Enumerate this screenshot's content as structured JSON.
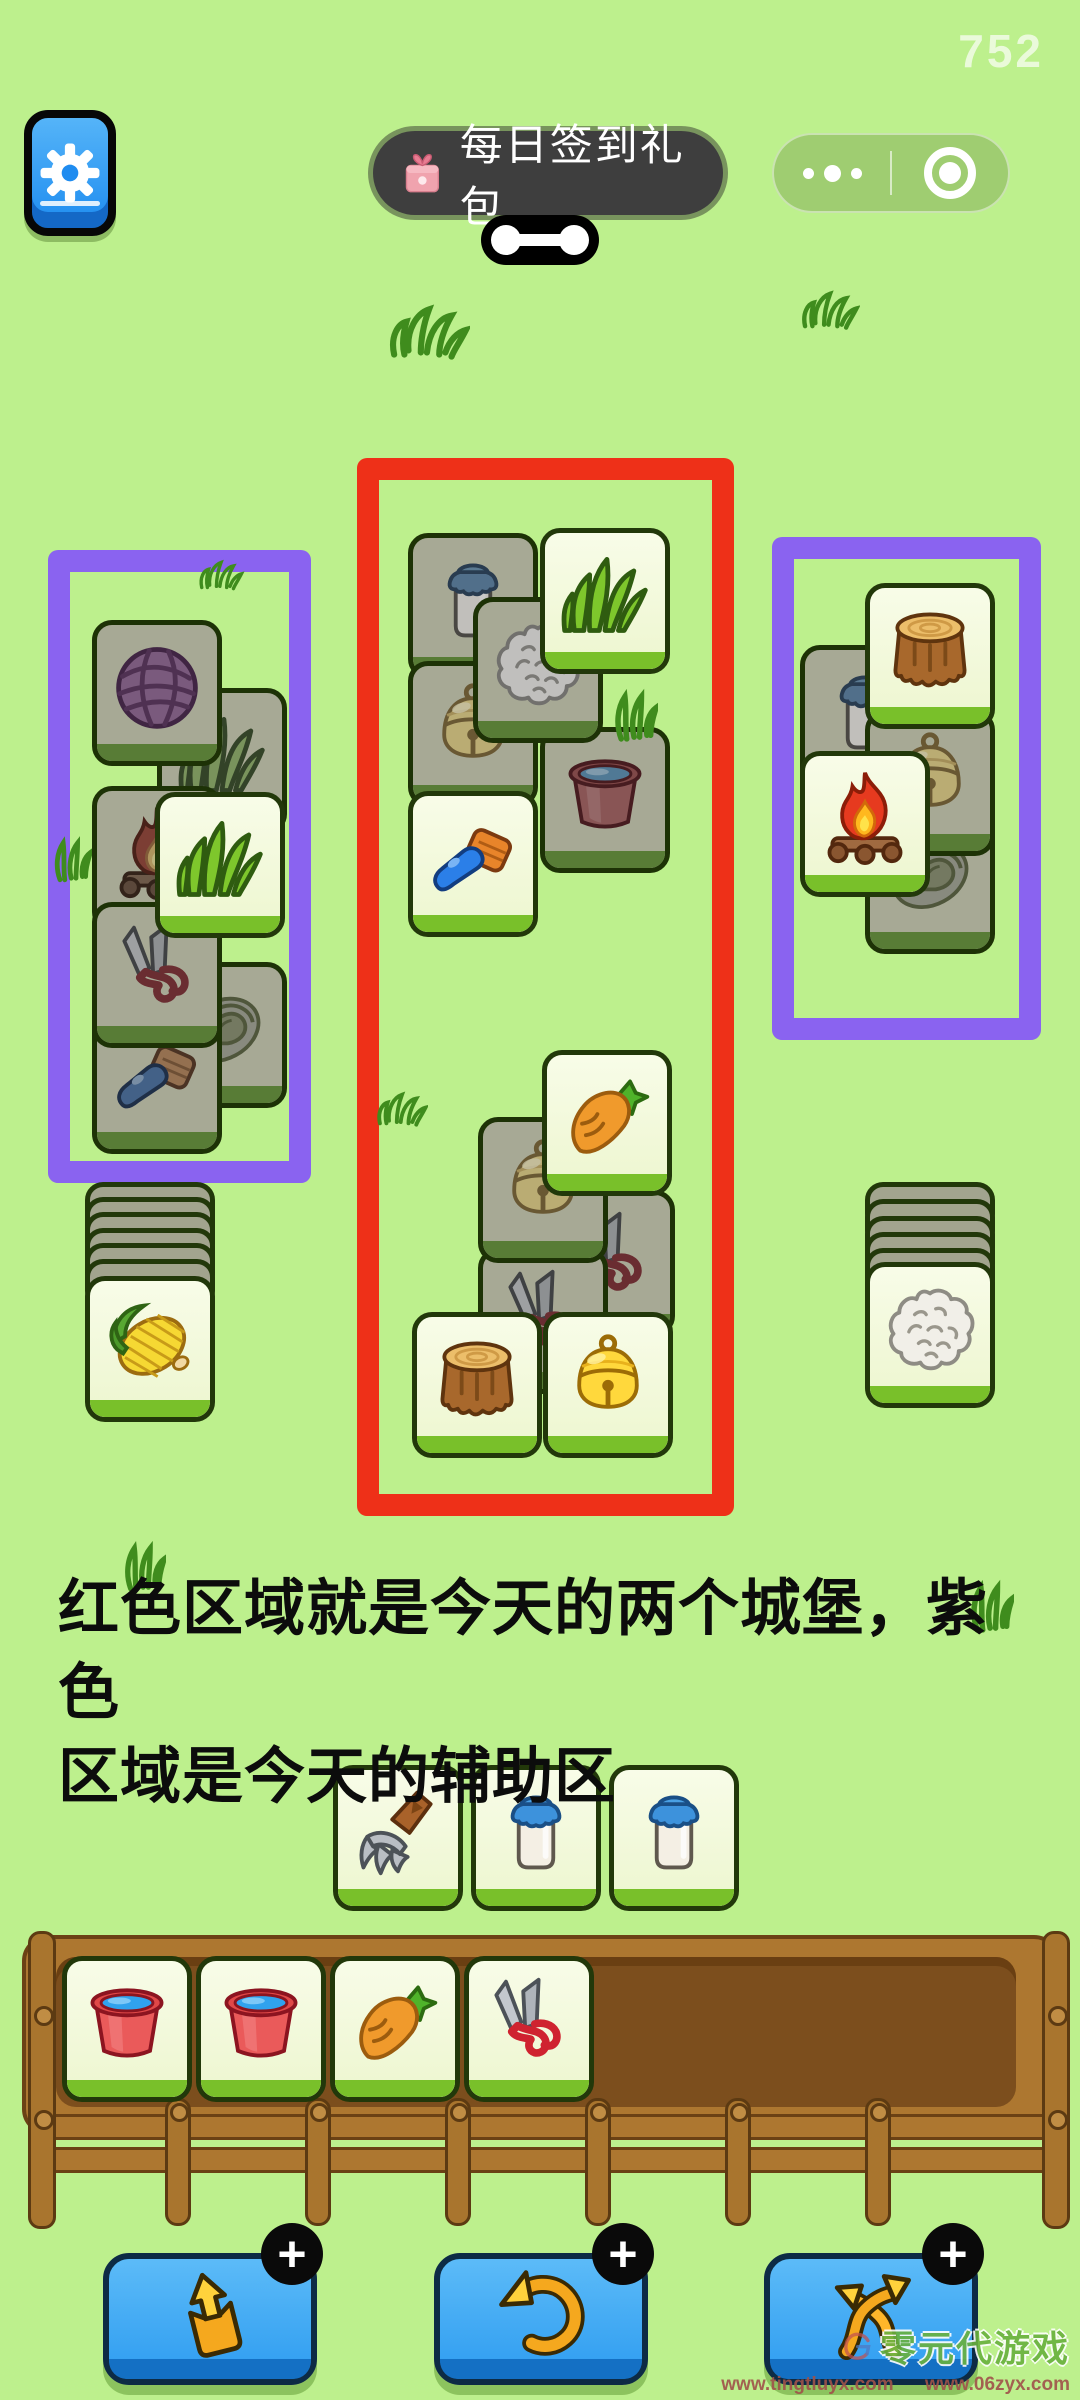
{
  "app": {
    "background": "#bdf08d"
  },
  "hud": {
    "score": "752",
    "signin": {
      "label": "每日签到礼包"
    },
    "capsule": {
      "more_icon": "three-dots",
      "close_icon": "record-target"
    }
  },
  "note": {
    "line1": "红色区域就是今天的两个城堡，紫色",
    "line2": "区域是今天的辅助区"
  },
  "zones": [
    {
      "id": "aux-left",
      "color": "#8a63f0",
      "x": 48,
      "y": 550,
      "w": 263,
      "h": 633
    },
    {
      "id": "castle-red",
      "color": "#ee3018",
      "x": 357,
      "y": 458,
      "w": 377,
      "h": 1058
    },
    {
      "id": "aux-right",
      "color": "#8a63f0",
      "x": 772,
      "y": 537,
      "w": 269,
      "h": 503
    }
  ],
  "board": {
    "tiles": [
      {
        "icon": "yarn",
        "variant": "dark",
        "x": 92,
        "y": 620,
        "z": 3
      },
      {
        "icon": "grass",
        "variant": "dark",
        "x": 157,
        "y": 688,
        "z": 2
      },
      {
        "icon": "fire",
        "variant": "dark",
        "x": 92,
        "y": 786,
        "z": 3
      },
      {
        "icon": "grass",
        "variant": "bright",
        "x": 155,
        "y": 792,
        "z": 5
      },
      {
        "icon": "scissors",
        "variant": "dark",
        "x": 92,
        "y": 902,
        "z": 4
      },
      {
        "icon": "lettuce",
        "variant": "dark",
        "x": 157,
        "y": 962,
        "z": 2
      },
      {
        "icon": "brush",
        "variant": "dark",
        "x": 92,
        "y": 1008,
        "z": 3
      },
      {
        "icon": "milk",
        "variant": "dark",
        "x": 408,
        "y": 533,
        "z": 2
      },
      {
        "icon": "grass",
        "variant": "bright",
        "x": 540,
        "y": 528,
        "z": 4
      },
      {
        "icon": "cotton",
        "variant": "dark",
        "x": 473,
        "y": 597,
        "z": 3
      },
      {
        "icon": "bell",
        "variant": "dark",
        "x": 408,
        "y": 661,
        "z": 2
      },
      {
        "icon": "bucket",
        "variant": "dark",
        "x": 540,
        "y": 727,
        "z": 2
      },
      {
        "icon": "brush",
        "variant": "bright",
        "x": 408,
        "y": 791,
        "z": 3
      },
      {
        "icon": "carrot",
        "variant": "bright",
        "x": 542,
        "y": 1050,
        "z": 4
      },
      {
        "icon": "bell",
        "variant": "dark",
        "x": 478,
        "y": 1117,
        "z": 3
      },
      {
        "icon": "scissors",
        "variant": "dark",
        "x": 545,
        "y": 1190,
        "z": 2
      },
      {
        "icon": "scissors",
        "variant": "dark",
        "x": 478,
        "y": 1248,
        "z": 2
      },
      {
        "icon": "stump",
        "variant": "bright",
        "x": 412,
        "y": 1312,
        "z": 5
      },
      {
        "icon": "bell",
        "variant": "bright",
        "x": 543,
        "y": 1312,
        "z": 5
      },
      {
        "icon": "milk",
        "variant": "dark",
        "x": 800,
        "y": 645,
        "z": 2
      },
      {
        "icon": "stump",
        "variant": "bright",
        "x": 865,
        "y": 583,
        "z": 4
      },
      {
        "icon": "bell",
        "variant": "dark",
        "x": 865,
        "y": 710,
        "z": 2
      },
      {
        "icon": "fire",
        "variant": "bright",
        "x": 800,
        "y": 751,
        "z": 4
      },
      {
        "icon": "lettuce",
        "variant": "dark",
        "x": 865,
        "y": 808,
        "z": 1
      },
      {
        "icon": "corn",
        "variant": "bright",
        "x": 85,
        "y": 1276,
        "z": 3
      },
      {
        "icon": "cotton",
        "variant": "bright",
        "x": 865,
        "y": 1262,
        "z": 3
      },
      {
        "icon": "pitchfork",
        "variant": "bright",
        "x": 333,
        "y": 1765,
        "z": 3
      },
      {
        "icon": "milk",
        "variant": "bright",
        "x": 471,
        "y": 1765,
        "z": 3
      },
      {
        "icon": "milk",
        "variant": "bright",
        "x": 609,
        "y": 1765,
        "z": 3
      },
      {
        "icon": "bucket",
        "variant": "bright",
        "x": 62,
        "y": 1956,
        "z": 6
      },
      {
        "icon": "bucket",
        "variant": "bright",
        "x": 196,
        "y": 1956,
        "z": 6
      },
      {
        "icon": "carrot",
        "variant": "bright",
        "x": 330,
        "y": 1956,
        "z": 6
      },
      {
        "icon": "scissors",
        "variant": "bright",
        "x": 464,
        "y": 1956,
        "z": 6
      }
    ],
    "pile_backs": [
      {
        "x": 85,
        "y": 1182
      },
      {
        "x": 85,
        "y": 1197
      },
      {
        "x": 85,
        "y": 1212
      },
      {
        "x": 85,
        "y": 1228
      },
      {
        "x": 85,
        "y": 1243
      },
      {
        "x": 85,
        "y": 1259
      },
      {
        "x": 865,
        "y": 1182
      },
      {
        "x": 865,
        "y": 1199
      },
      {
        "x": 865,
        "y": 1216
      },
      {
        "x": 865,
        "y": 1232
      },
      {
        "x": 865,
        "y": 1248
      }
    ]
  },
  "doodles": [
    {
      "kind": "m",
      "x": 388,
      "y": 300,
      "w": 82,
      "h": 64
    },
    {
      "kind": "m",
      "x": 800,
      "y": 288,
      "w": 60,
      "h": 44
    },
    {
      "kind": "m",
      "x": 196,
      "y": 558,
      "w": 50,
      "h": 34
    },
    {
      "kind": "curl",
      "x": 52,
      "y": 832,
      "w": 40,
      "h": 54
    },
    {
      "kind": "curl",
      "x": 612,
      "y": 686,
      "w": 46,
      "h": 58
    },
    {
      "kind": "m",
      "x": 376,
      "y": 1086,
      "w": 52,
      "h": 46
    },
    {
      "kind": "curl",
      "x": 968,
      "y": 1578,
      "w": 46,
      "h": 56
    },
    {
      "kind": "curl",
      "x": 122,
      "y": 1538,
      "w": 44,
      "h": 56
    }
  ],
  "actions": {
    "buttons": [
      {
        "name": "eject-tiles",
        "icon": "eject",
        "badge": "+",
        "x": 103
      },
      {
        "name": "undo",
        "icon": "undo",
        "badge": "+",
        "x": 434
      },
      {
        "name": "shuffle",
        "icon": "shuffle",
        "badge": "+",
        "x": 764
      }
    ]
  },
  "watermark": {
    "brand": "零元代游戏",
    "url1": "www.tingtluyx.com",
    "url2": "www.06zyx.com"
  }
}
